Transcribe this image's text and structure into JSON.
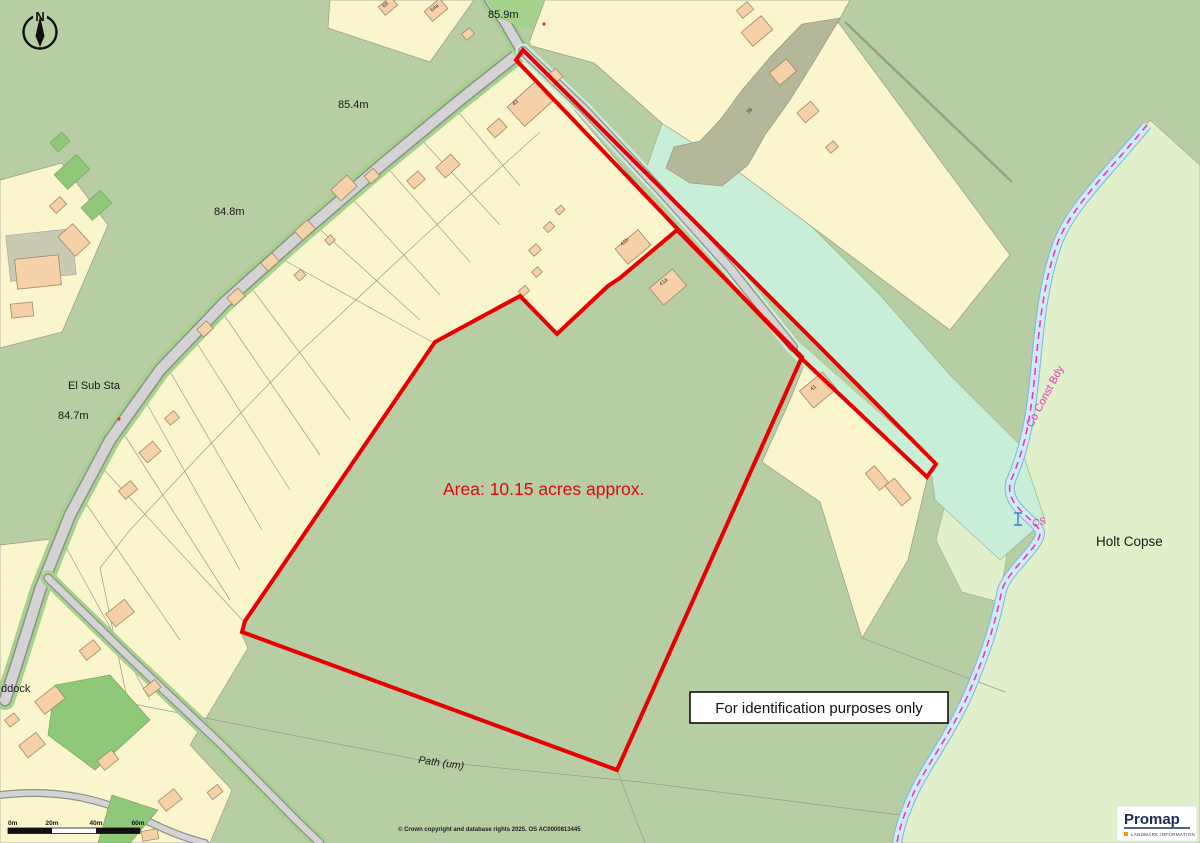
{
  "map": {
    "area_label": "Area: 10.15 acres approx.",
    "identification_note": "For identification purposes only",
    "north_label": "N",
    "place_labels": {
      "holt_copse": "Holt Copse",
      "el_sub_sta": "El Sub Sta",
      "paddock": "ddock",
      "path": "Path (um)",
      "co_const_bdy": "Co Const Bdy",
      "cs": "CS"
    },
    "spot_heights": {
      "h859": "85.9m",
      "h854": "85.4m",
      "h848": "84.8m",
      "h847": "84.7m"
    },
    "house_numbers": {
      "n68": "68",
      "n64a": "64a",
      "n43": "43",
      "n41b": "41b",
      "n41a": "41a",
      "n41": "41",
      "n36": "36"
    },
    "scale_bar": {
      "t0": "0m",
      "t20": "20m",
      "t40": "40m",
      "t60": "60m"
    },
    "copyright": "© Crown copyright and database rights 2025. OS AC0000813445",
    "logo": {
      "brand": "Promap",
      "sub": "LANDMARK INFORMATION"
    },
    "colors": {
      "boundary_red": "#e80000",
      "county_boundary_magenta": "#e93ab2",
      "stream_blue": "#cfe9f7",
      "field_green": "#b7cda3",
      "parcel_yellow": "#fbf5cd",
      "building_salmon": "#f6d0a7",
      "woodland_pale_green": "#dff0ca",
      "roadside_mint": "#c9eed8",
      "verge_green": "#a4d18c",
      "area_text_red": "#e30613"
    }
  }
}
